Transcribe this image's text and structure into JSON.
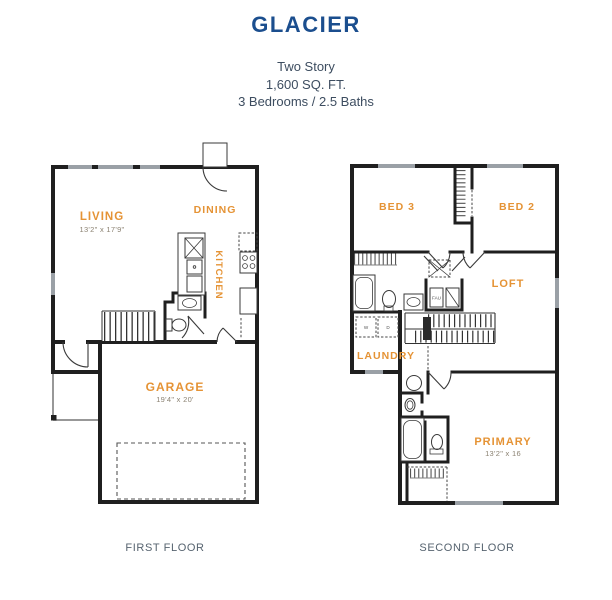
{
  "header": {
    "title": "GLACIER",
    "subtitle": [
      "Two Story",
      "1,600 SQ. FT.",
      "3 Bedrooms / 2.5 Baths"
    ]
  },
  "colors": {
    "title": "#1B4E8E",
    "subtitle_text": "#3D4D60",
    "room_label": "#E59335",
    "kitchen_label": "#C9A95C",
    "dimension_text": "#8B8272",
    "walls": "#1F1F1F",
    "caption": "#56636F"
  },
  "first_floor": {
    "caption": "FIRST FLOOR",
    "rooms": {
      "living": {
        "label": "LIVING",
        "dims": "13'2\" x 17'9\""
      },
      "dining": {
        "label": "DINING"
      },
      "kitchen": {
        "label": "KITCHEN"
      },
      "garage": {
        "label": "GARAGE",
        "dims": "19'4\" x 20'"
      }
    }
  },
  "second_floor": {
    "caption": "SECOND FLOOR",
    "rooms": {
      "bed3": {
        "label": "BED 3"
      },
      "bed2": {
        "label": "BED 2"
      },
      "loft": {
        "label": "LOFT"
      },
      "laundry": {
        "label": "LAUNDRY"
      },
      "primary": {
        "label": "PRIMARY",
        "dims": "13'2\" x 16"
      }
    },
    "labels": {
      "washer": "W",
      "dryer": "D",
      "fau": "FAU"
    }
  }
}
